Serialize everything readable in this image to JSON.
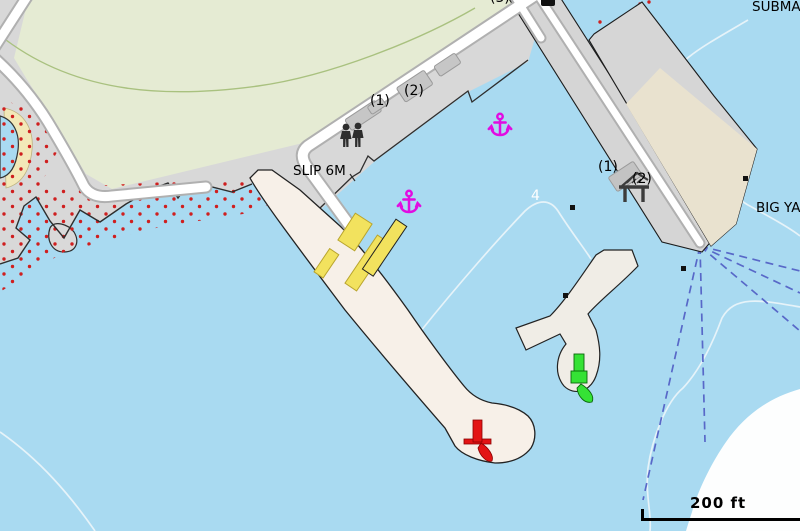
{
  "map": {
    "labels": {
      "slip_6m": "SLIP 6M",
      "submarine": "SUBMAR",
      "big_yacht": "BIG YA",
      "pier_west_berth_1": "(1)",
      "pier_west_berth_2": "(2)",
      "pier_north_berth_3": "(3)",
      "pier_east_berth_1": "(1)",
      "pier_east_berth_2": "(2)",
      "depth_sounding_4": "4"
    },
    "scale_bar": {
      "label": "200 ft"
    },
    "colors": {
      "water": "#a9daf1",
      "land": "#d8d8d8",
      "park": "#e5ebd3",
      "breakwater": "#f7f0e8",
      "pier_apron": "#e9e2cf",
      "pontoon_yellow": "#f2e25e",
      "anchorage_magenta": "#e10ce1",
      "port_hand_red": "#e31414",
      "starboard_hand_green": "#35e235",
      "route_dashed_blue": "#5868c8",
      "foul_area_dots_red": "#cf1f1f"
    },
    "features": [
      {
        "name": "anchorage-symbol",
        "count": 2
      },
      {
        "name": "red-beacon",
        "count": 1
      },
      {
        "name": "green-beacon",
        "count": 1
      },
      {
        "name": "yellow-pontoons",
        "count": 4
      },
      {
        "name": "pedestrians-icon",
        "count": 1
      },
      {
        "name": "boat-lift-icon",
        "count": 1
      }
    ]
  }
}
